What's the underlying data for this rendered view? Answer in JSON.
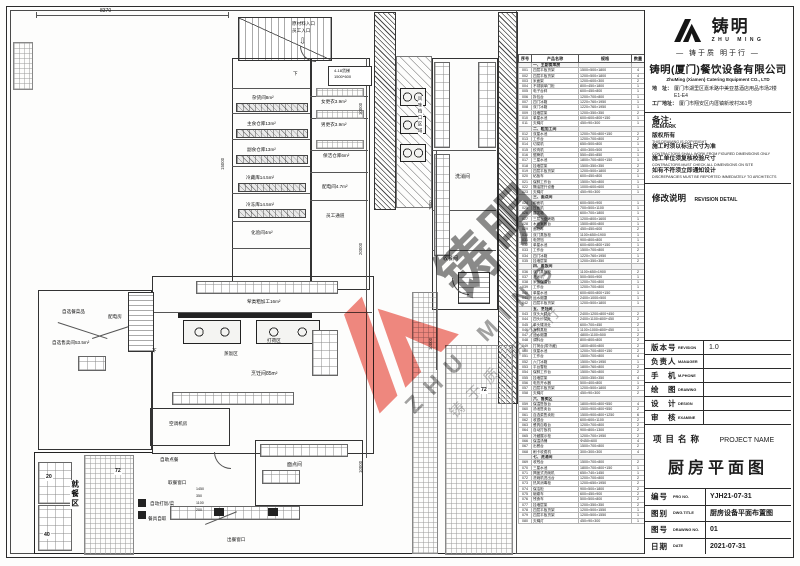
{
  "colors": {
    "line": "#333333",
    "watermark_red": "#e95a4f",
    "watermark_gray": "#6a6a6a"
  },
  "watermark": {
    "name_zh": "铸明",
    "name_en": "ZHU MING",
    "tagline": "铸于质 明于行"
  },
  "company": {
    "logo_zh": "铸明",
    "logo_en": "ZHU MING",
    "tagline_framed": "— 铸于质 明于行 —",
    "name_zh": "铸明(厦门)餐饮设备有限公司",
    "name_en": "ZhuMing (Xiamen) Catering Equipment CO., LTD",
    "addr_label": "地　址：",
    "addr": "厦门市湖里区嘉禾路中美亚基酒店用品市场2楼E1-E4",
    "factory_label": "工厂地址：",
    "factory": "厦门市翔安区内厝镇新垵村361号"
  },
  "remark": {
    "label_zh": "备注:",
    "label_en": "REMARK",
    "items": [
      {
        "zh": "版权所有",
        "en": "THIS DRAWING IS COPYRIGHT"
      },
      {
        "zh": "施工时须以标注尺寸为准",
        "en": "CONTRACTORS SHALL WORK FROM FIGURED DIMENSIONS ONLY"
      },
      {
        "zh": "施工单位须复核校验尺寸",
        "en": "CONTRACTORS MUST CHECK ALL DIMENSIONS ON SITE"
      },
      {
        "zh": "如有不符须立即通知设计",
        "en": "DISCREPANCIES MUST BE REPORTED IMMEDIATELY TO ARCHITECTS"
      }
    ]
  },
  "revision": {
    "label_zh": "修改说明",
    "label_en": "REVISION DETAIL"
  },
  "fields": {
    "rows": [
      {
        "zh": "版本号",
        "en": "REVISION",
        "val": "1.0"
      },
      {
        "zh": "负责人",
        "en": "MANAGER",
        "val": ""
      },
      {
        "zh": "手　机",
        "en": "M.PHONE",
        "val": ""
      },
      {
        "zh": "绘　图",
        "en": "DRAWING",
        "val": ""
      },
      {
        "zh": "设　计",
        "en": "DESIGN",
        "val": ""
      },
      {
        "zh": "审　核",
        "en": "EXAMINE",
        "val": ""
      }
    ]
  },
  "project": {
    "zh": "项目名称",
    "en": "PROJECT NAME",
    "name": "厨房平面图"
  },
  "doc": {
    "rows": [
      {
        "zh": "编号",
        "en": "PRO NO.",
        "val": "YJH21-07-31"
      },
      {
        "zh": "图别",
        "en": "DWG.TITLE",
        "val": "厨房设备平面布置图"
      },
      {
        "zh": "图号",
        "en": "DRAWING NO.",
        "val": "01"
      },
      {
        "zh": "日期",
        "en": "DATE",
        "val": "2021-07-31"
      }
    ]
  },
  "plan": {
    "labels": [
      "8370",
      "原材料入口",
      "员工入口",
      "4-18货梯",
      "1500*600",
      "杂货间8m²",
      "主食仓库13m²",
      "副食仓库13m²",
      "冷藏库14.5m²",
      "冷冻库14.5m²",
      "化验间4m²",
      "女更衣3.9m²",
      "男更衣3.9m²",
      "保洁仓库6m²",
      "配电间4.7m²",
      "员工通道",
      "风味档口区域",
      "洗消间",
      "收餐间",
      "荤类粗加工16m²",
      "打荷区",
      "蒸饭区",
      "烹饪间85m²",
      "自选餐菜品",
      "自选售卖间53.5m²",
      "配电房",
      "空调机房",
      "面点间",
      "就餐区",
      "20",
      "40",
      "72",
      "72",
      "出餐窗口",
      "自助点餐",
      "取餐窗口",
      "自动打饭/菜",
      "餐具自取",
      "下",
      "下",
      "10000",
      "20000",
      "7000",
      "10000",
      "10000",
      "15000",
      "1450",
      "350",
      "1100",
      "200"
    ]
  },
  "equipment_table": {
    "headers": [
      "序号",
      "产品名称",
      "规格",
      "数量"
    ],
    "rows": [
      {
        "sec": true,
        "name": "一、主副食库房"
      },
      {
        "no": "001",
        "name": "四层平板货架",
        "spec": "1500×500×1800",
        "qty": "4"
      },
      {
        "no": "002",
        "name": "四层平板货架",
        "spec": "1200×500×1800",
        "qty": "4"
      },
      {
        "no": "003",
        "name": "米面架",
        "spec": "1200×600×300",
        "qty": "2"
      },
      {
        "no": "004",
        "name": "不锈钢单门柜",
        "spec": "800×450×1800",
        "qty": "1"
      },
      {
        "no": "005",
        "name": "电子台秤",
        "spec": "600×450×800",
        "qty": "1"
      },
      {
        "no": "006",
        "name": "拆包台",
        "spec": "1200×700×800",
        "qty": "1"
      },
      {
        "no": "007",
        "name": "四门冰箱",
        "spec": "1220×760×1950",
        "qty": "1"
      },
      {
        "no": "008",
        "name": "双门冰箱",
        "spec": "1220×760×1950",
        "qty": "1"
      },
      {
        "no": "009",
        "name": "挂墙层架",
        "spec": "1200×350×350",
        "qty": "2"
      },
      {
        "no": "010",
        "name": "单星水池",
        "spec": "600×600×800+150",
        "qty": "1"
      },
      {
        "no": "011",
        "name": "灭蝇灯",
        "spec": "450×90×300",
        "qty": "1"
      },
      {
        "sec": true,
        "name": "二、粗加工间"
      },
      {
        "no": "012",
        "name": "双星水池",
        "spec": "1200×700×800+150",
        "qty": "2"
      },
      {
        "no": "013",
        "name": "工作台",
        "spec": "1200×700×800",
        "qty": "2"
      },
      {
        "no": "014",
        "name": "切菜机",
        "spec": "650×500×800",
        "qty": "1"
      },
      {
        "no": "015",
        "name": "绞肉机",
        "spec": "400×300×500",
        "qty": "1"
      },
      {
        "no": "016",
        "name": "锯骨机",
        "spec": "550×450×850",
        "qty": "1"
      },
      {
        "no": "017",
        "name": "三星水池",
        "spec": "1800×700×800+150",
        "qty": "1"
      },
      {
        "no": "018",
        "name": "挂墙层架",
        "spec": "1500×350×350",
        "qty": "2"
      },
      {
        "no": "019",
        "name": "四层平板货架",
        "spec": "1200×500×1800",
        "qty": "2"
      },
      {
        "no": "020",
        "name": "砧板车",
        "spec": "600×450×800",
        "qty": "1"
      },
      {
        "no": "021",
        "name": "保鲜工作台",
        "spec": "1500×760×800",
        "qty": "1"
      },
      {
        "no": "022",
        "name": "隔油提升设备",
        "spec": "1000×600×600",
        "qty": "1"
      },
      {
        "no": "023",
        "name": "灭蝇灯",
        "spec": "450×90×300",
        "qty": "1"
      },
      {
        "sec": true,
        "name": "三、面点间"
      },
      {
        "no": "024",
        "name": "和面机",
        "spec": "600×500×900",
        "qty": "1"
      },
      {
        "no": "025",
        "name": "压面机",
        "spec": "700×500×1100",
        "qty": "1"
      },
      {
        "no": "026",
        "name": "醒发箱",
        "spec": "600×700×1800",
        "qty": "1"
      },
      {
        "no": "027",
        "name": "三层六盘烤箱",
        "spec": "1200×800×1600",
        "qty": "1"
      },
      {
        "no": "028",
        "name": "木面案板台",
        "spec": "1500×800×800",
        "qty": "1"
      },
      {
        "no": "029",
        "name": "面粉车",
        "spec": "450×450×600",
        "qty": "2"
      },
      {
        "no": "030",
        "name": "双门蒸饭柜",
        "spec": "1100×650×1900",
        "qty": "1"
      },
      {
        "no": "031",
        "name": "电饼铛",
        "spec": "900×800×800",
        "qty": "1"
      },
      {
        "no": "032",
        "name": "单星水池",
        "spec": "600×600×800+150",
        "qty": "1"
      },
      {
        "no": "033",
        "name": "工作台",
        "spec": "1500×700×800",
        "qty": "2"
      },
      {
        "no": "034",
        "name": "四门冰箱",
        "spec": "1220×760×1950",
        "qty": "1"
      },
      {
        "no": "035",
        "name": "挂墙层架",
        "spec": "1200×350×350",
        "qty": "2"
      },
      {
        "sec": true,
        "name": "四、蒸饭间"
      },
      {
        "no": "036",
        "name": "双门蒸饭柜",
        "spec": "1100×650×1900",
        "qty": "2"
      },
      {
        "no": "037",
        "name": "洗米机",
        "spec": "500×500×900",
        "qty": "1"
      },
      {
        "no": "038",
        "name": "米饭保温台",
        "spec": "1200×700×800",
        "qty": "1"
      },
      {
        "no": "039",
        "name": "工作台",
        "spec": "1200×700×800",
        "qty": "1"
      },
      {
        "no": "040",
        "name": "单星水池",
        "spec": "600×600×800+150",
        "qty": "1"
      },
      {
        "no": "041",
        "name": "运水烟罩",
        "spec": "2400×1000×500",
        "qty": "1"
      },
      {
        "no": "042",
        "name": "四层平板货架",
        "spec": "1200×500×1800",
        "qty": "1"
      },
      {
        "sec": true,
        "name": "五、烹饪间"
      },
      {
        "no": "043",
        "name": "双头大锅灶",
        "spec": "2400×1200×800+450",
        "qty": "2"
      },
      {
        "no": "044",
        "name": "四头炒菜灶",
        "spec": "2400×1100×800+450",
        "qty": "2"
      },
      {
        "no": "045",
        "name": "单头矮汤灶",
        "spec": "600×700×450",
        "qty": "2"
      },
      {
        "no": "046",
        "name": "海鲜蒸柜",
        "spec": "1100×1000×800+450",
        "qty": "1"
      },
      {
        "no": "047",
        "name": "运水烟罩",
        "spec": "4800×1100×500",
        "qty": "2"
      },
      {
        "no": "048",
        "name": "调料台",
        "spec": "800×800×800",
        "qty": "2"
      },
      {
        "no": "049",
        "name": "打荷台(带冷藏)",
        "spec": "1800×800×800",
        "qty": "2"
      },
      {
        "no": "050",
        "name": "双星水池",
        "spec": "1200×700×800+150",
        "qty": "2"
      },
      {
        "no": "051",
        "name": "工作台",
        "spec": "1500×700×800",
        "qty": "4"
      },
      {
        "no": "052",
        "name": "六门冰箱",
        "spec": "1500×760×1950",
        "qty": "1"
      },
      {
        "no": "053",
        "name": "平台雪柜",
        "spec": "1800×760×800",
        "qty": "2"
      },
      {
        "no": "054",
        "name": "保鲜工作台",
        "spec": "1500×760×800",
        "qty": "2"
      },
      {
        "no": "055",
        "name": "挂墙层架",
        "spec": "1500×350×350",
        "qty": "4"
      },
      {
        "no": "056",
        "name": "电热开水器",
        "spec": "500×400×800",
        "qty": "1"
      },
      {
        "no": "057",
        "name": "四层平板货架",
        "spec": "1200×500×1800",
        "qty": "2"
      },
      {
        "no": "058",
        "name": "灭蝇灯",
        "spec": "450×90×300",
        "qty": "2"
      },
      {
        "sec": true,
        "name": "六、售卖区"
      },
      {
        "no": "059",
        "name": "保温售饭台",
        "spec": "1800×900×800+550",
        "qty": "4"
      },
      {
        "no": "060",
        "name": "汤池售卖台",
        "spec": "1500×900×800+550",
        "qty": "2"
      },
      {
        "no": "061",
        "name": "自选菜售卖柜",
        "spec": "1500×900×800+1250",
        "qty": "6"
      },
      {
        "no": "062",
        "name": "收银台",
        "spec": "600×600×1100",
        "qty": "2"
      },
      {
        "no": "063",
        "name": "餐具自取台",
        "spec": "1200×700×800",
        "qty": "2"
      },
      {
        "no": "064",
        "name": "自动打饭机",
        "spec": "900×800×1300",
        "qty": "2"
      },
      {
        "no": "065",
        "name": "冷藏展示柜",
        "spec": "1200×700×1950",
        "qty": "2"
      },
      {
        "no": "066",
        "name": "保温汤桶",
        "spec": "Φ450×600",
        "qty": "4"
      },
      {
        "no": "067",
        "name": "出餐台",
        "spec": "1500×700×800",
        "qty": "2"
      },
      {
        "no": "068",
        "name": "刷卡收费机",
        "spec": "300×300×300",
        "qty": "4"
      },
      {
        "sec": true,
        "name": "七、洗消间"
      },
      {
        "no": "069",
        "name": "收残台",
        "spec": "1500×700×800",
        "qty": "2"
      },
      {
        "no": "070",
        "name": "三星水池",
        "spec": "1800×700×800+150",
        "qty": "1"
      },
      {
        "no": "071",
        "name": "揭盖式洗碗机",
        "spec": "650×740×1450",
        "qty": "1"
      },
      {
        "no": "072",
        "name": "洗碗机进出台",
        "spec": "1200×700×800",
        "qty": "2"
      },
      {
        "no": "073",
        "name": "热风消毒柜",
        "spec": "1200×650×1950",
        "qty": "2"
      },
      {
        "no": "074",
        "name": "保洁柜",
        "spec": "900×500×1800",
        "qty": "2"
      },
      {
        "no": "075",
        "name": "碗碟车",
        "spec": "600×450×900",
        "qty": "2"
      },
      {
        "no": "076",
        "name": "残食车",
        "spec": "500×500×800",
        "qty": "2"
      },
      {
        "no": "077",
        "name": "挂墙层架",
        "spec": "1200×350×350",
        "qty": "2"
      },
      {
        "no": "078",
        "name": "四层平板货架",
        "spec": "1200×500×1550",
        "qty": "1"
      },
      {
        "no": "079",
        "name": "四层平板货架",
        "spec": "1200×500×1550",
        "qty": "1"
      },
      {
        "no": "080",
        "name": "灭蝇灯",
        "spec": "450×90×300",
        "qty": "1"
      }
    ]
  }
}
